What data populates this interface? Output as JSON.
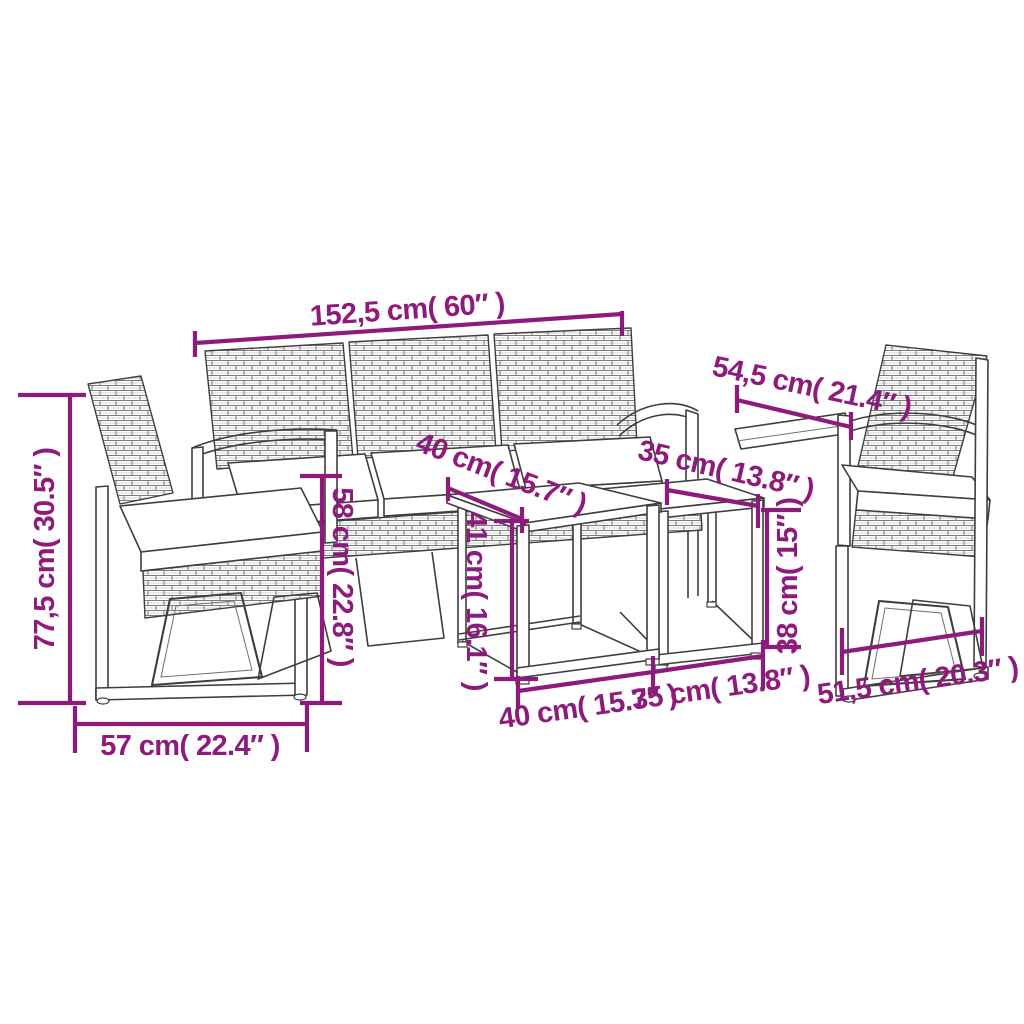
{
  "canvas": {
    "width": 1024,
    "height": 1024,
    "background": "#ffffff"
  },
  "style": {
    "dimension_color": "#8E1A7C",
    "line_art_color": "#3E3E3E",
    "cushion_color": "#ffffff"
  },
  "shapes": {
    "sofa": "three-seat-rattan-sofa",
    "left_chair": "rattan-armchair-left",
    "right_chair": "rattan-armchair-right",
    "large_table": "nesting-side-table-large",
    "small_table": "nesting-side-table-small"
  },
  "dimensions": {
    "sofa_width": "152,5 cm( 60″ )",
    "seat_depth": "54,5 cm( 21.4″ )",
    "chair_height": "77,5 cm( 30.5″ )",
    "left_chair_width": "57 cm( 22.4″ )",
    "large_table_top_depth": "40 cm( 15.7″ )",
    "small_table_top_depth": "35 cm( 13.8″ )",
    "seat_height": "58 cm( 22.8″ )",
    "large_table_height": "41 cm( 16.1″ )",
    "small_table_height": "38 cm( 15″ )",
    "large_table_width": "40 cm( 15.7″ )",
    "small_table_width": "35 cm( 13.8″ )",
    "right_chair_width": "51,5 cm( 20.3″ )"
  }
}
